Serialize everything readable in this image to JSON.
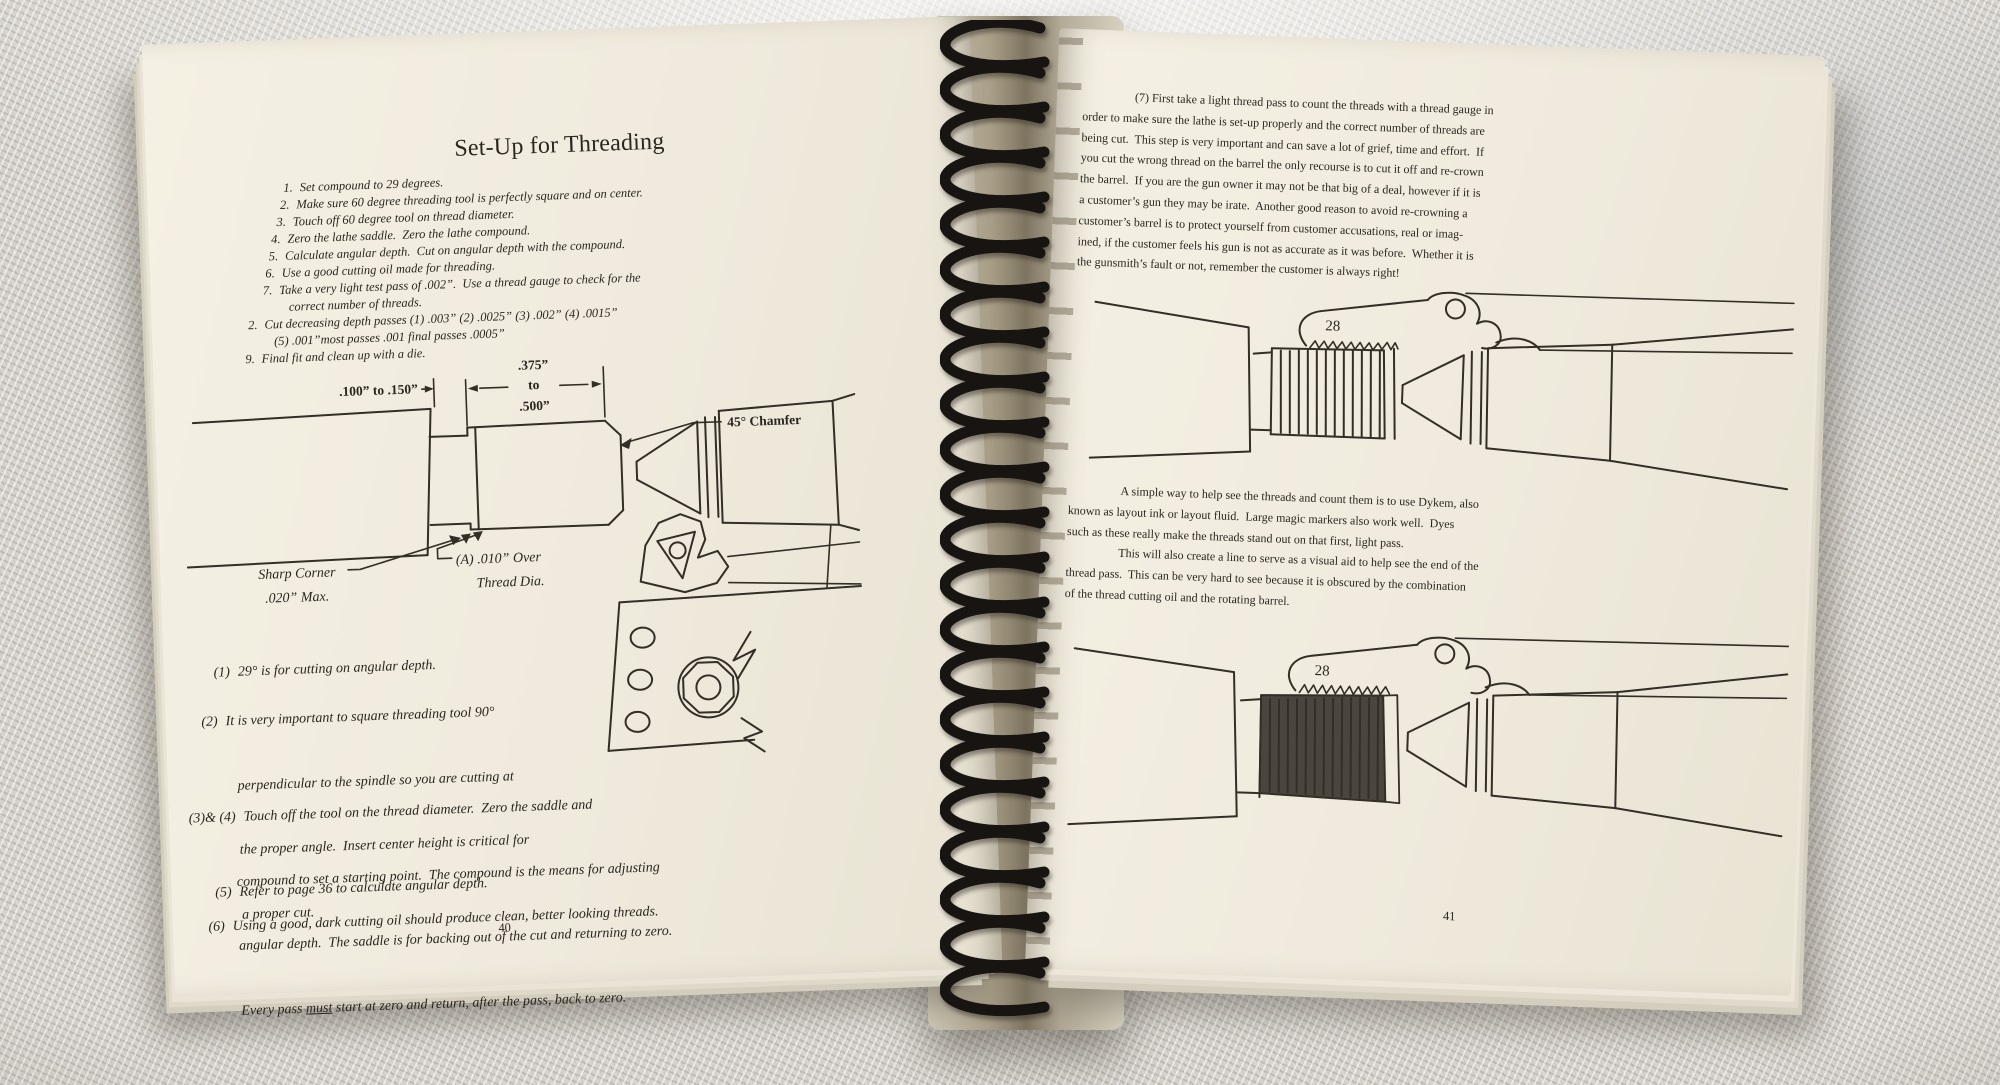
{
  "left_page": {
    "title": "Set-Up for Threading",
    "steps": [
      {
        "num": "1.",
        "text": "Set compound to 29 degrees."
      },
      {
        "num": "2.",
        "text": "Make sure 60 degree threading tool is perfectly square and on center."
      },
      {
        "num": "3.",
        "text": "Touch off 60 degree tool on thread diameter."
      },
      {
        "num": "4.",
        "text": "Zero the lathe saddle.  Zero the lathe compound."
      },
      {
        "num": "5.",
        "text": "Calculate angular depth.  Cut on angular depth with the compound."
      },
      {
        "num": "6.",
        "text": "Use a good cutting oil made for threading."
      },
      {
        "num": "7.",
        "text": "Take a very light test pass of .002”.  Use a thread gauge to check for the",
        "text2": "correct number of threads."
      },
      {
        "num": "2.",
        "text": "Cut decreasing depth passes (1) .003” (2) .0025” (3) .002” (4) .0015”",
        "text2": "(5) .001”most passes .001 final passes .0005”"
      },
      {
        "num": "9.",
        "text": "Final fit and clean up with a die."
      }
    ],
    "diagram": {
      "dim_left": ".100” to .150”",
      "dim_a": ".375”",
      "dim_b": "to",
      "dim_c": ".500”",
      "chamfer": "45° Chamfer",
      "sharp1": "Sharp Corner",
      "sharp2": ".020” Max.",
      "overa": "(A) .010” Over",
      "overb": "Thread Dia."
    },
    "notes": {
      "n1_num": "(1)",
      "n1": "29° is for cutting on angular depth.",
      "n2_num": "(2)",
      "n2_l1": "It is very important to square threading tool 90°",
      "n2_l2": "perpendicular to the spindle so you are cutting at",
      "n2_l3": "the proper angle.  Insert center height is critical for",
      "n2_l4": "a proper cut.",
      "n34_num": "(3)& (4)",
      "n34_l1": "Touch off the tool on the thread diameter.  Zero the saddle and",
      "n34_l2": "compound to set a starting point.  The compound is the means for adjusting",
      "n34_l3": "angular depth.  The saddle is for backing out of the cut and returning to zero.",
      "n34_l4_pre": "Every pass ",
      "n34_l4_u": "must",
      "n34_l4_post": " start at zero and return, after the pass, back to zero.",
      "n5_num": "(5)",
      "n5": "Refer to page 36 to calculate angular depth.",
      "n6_num": "(6)",
      "n6": "Using a good, dark cutting oil should produce clean, better looking threads."
    },
    "page_number": "40"
  },
  "right_page": {
    "para1": [
      "(7) First take a light thread pass to count the threads with a thread gauge in",
      "order to make sure the lathe is set-up properly and the correct number of threads are",
      "being cut.  This step is very important and can save a lot of grief, time and effort.  If",
      "you cut the wrong thread on the barrel the only recourse is to cut it off and re-crown",
      "the barrel.  If you are the gun owner it may not be that big of a deal, however if it is",
      "a customer’s gun they may be irate.  Another good reason to avoid re-crowning a",
      "customer’s barrel is to protect yourself from customer accusations, real or imag-",
      "ined, if the customer feels his gun is not as accurate as it was before.  Whether it is",
      "the gunsmith’s fault or not, remember the customer is always right!"
    ],
    "para2": [
      "A simple way to help see the threads and count them is to use Dykem, also",
      "known as layout ink or layout fluid.  Large magic markers also work well.  Dyes",
      "such as these really make the threads stand out on that first, light pass.",
      "This will also create a line to serve as a visual aid to help see the end of the",
      "thread pass.  This can be very hard to see because it is obscured by the combination",
      "of the thread cutting oil and the rotating barrel."
    ],
    "gauge1": "28",
    "gauge2": "28",
    "page_number": "41"
  }
}
